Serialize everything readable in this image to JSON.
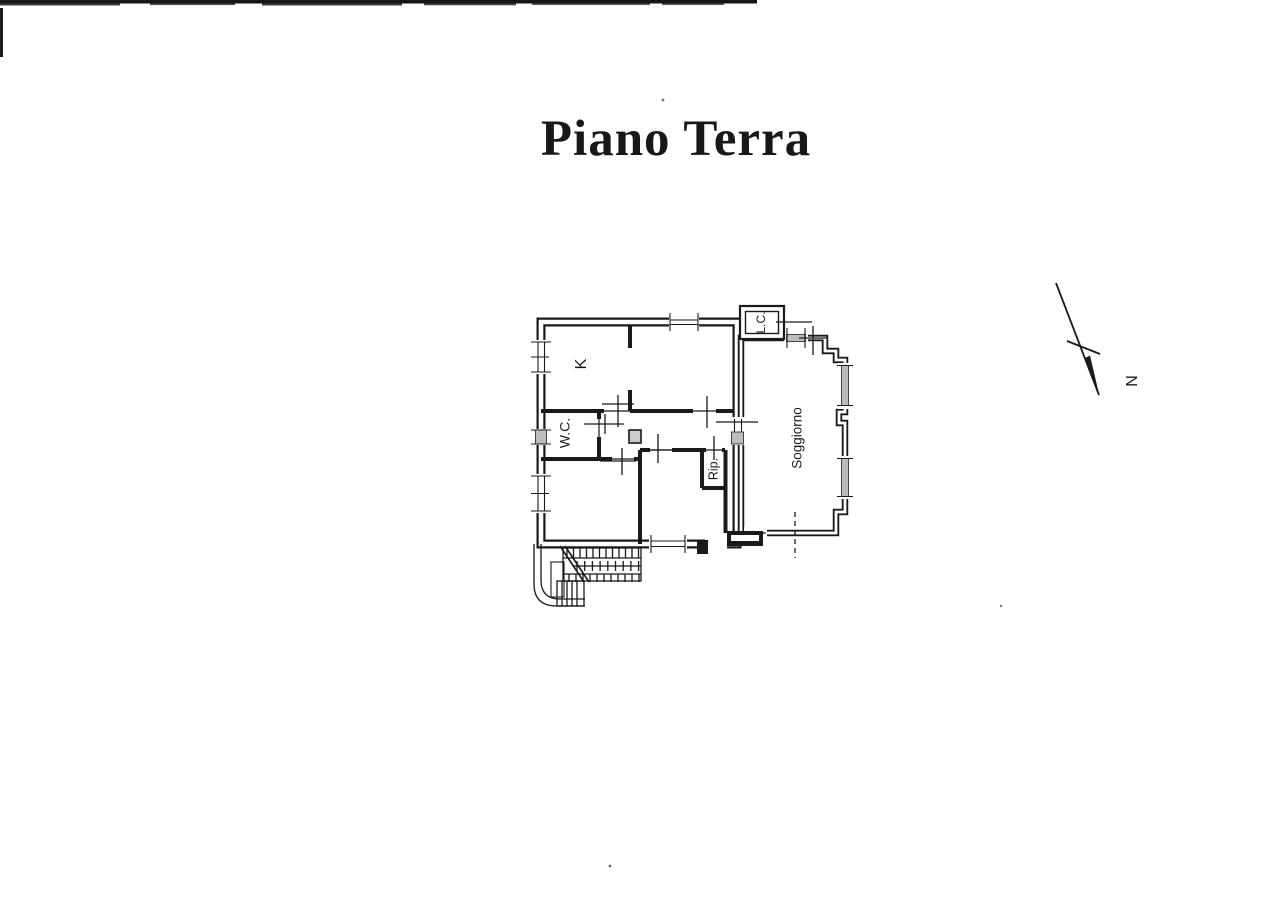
{
  "page": {
    "title": "Piano Terra"
  },
  "floor_plan": {
    "rooms": [
      {
        "id": "kitchen",
        "label": "K"
      },
      {
        "id": "wc",
        "label": "W.C."
      },
      {
        "id": "storage",
        "label": "Rip."
      },
      {
        "id": "living-room",
        "label": "Soggiorno"
      },
      {
        "id": "light-court",
        "label": "L.C."
      }
    ],
    "compass": {
      "north_label": "N"
    }
  },
  "colors": {
    "ink": "#1a1a1a",
    "paper": "#ffffff",
    "window_fill": "#bdbdbd"
  }
}
